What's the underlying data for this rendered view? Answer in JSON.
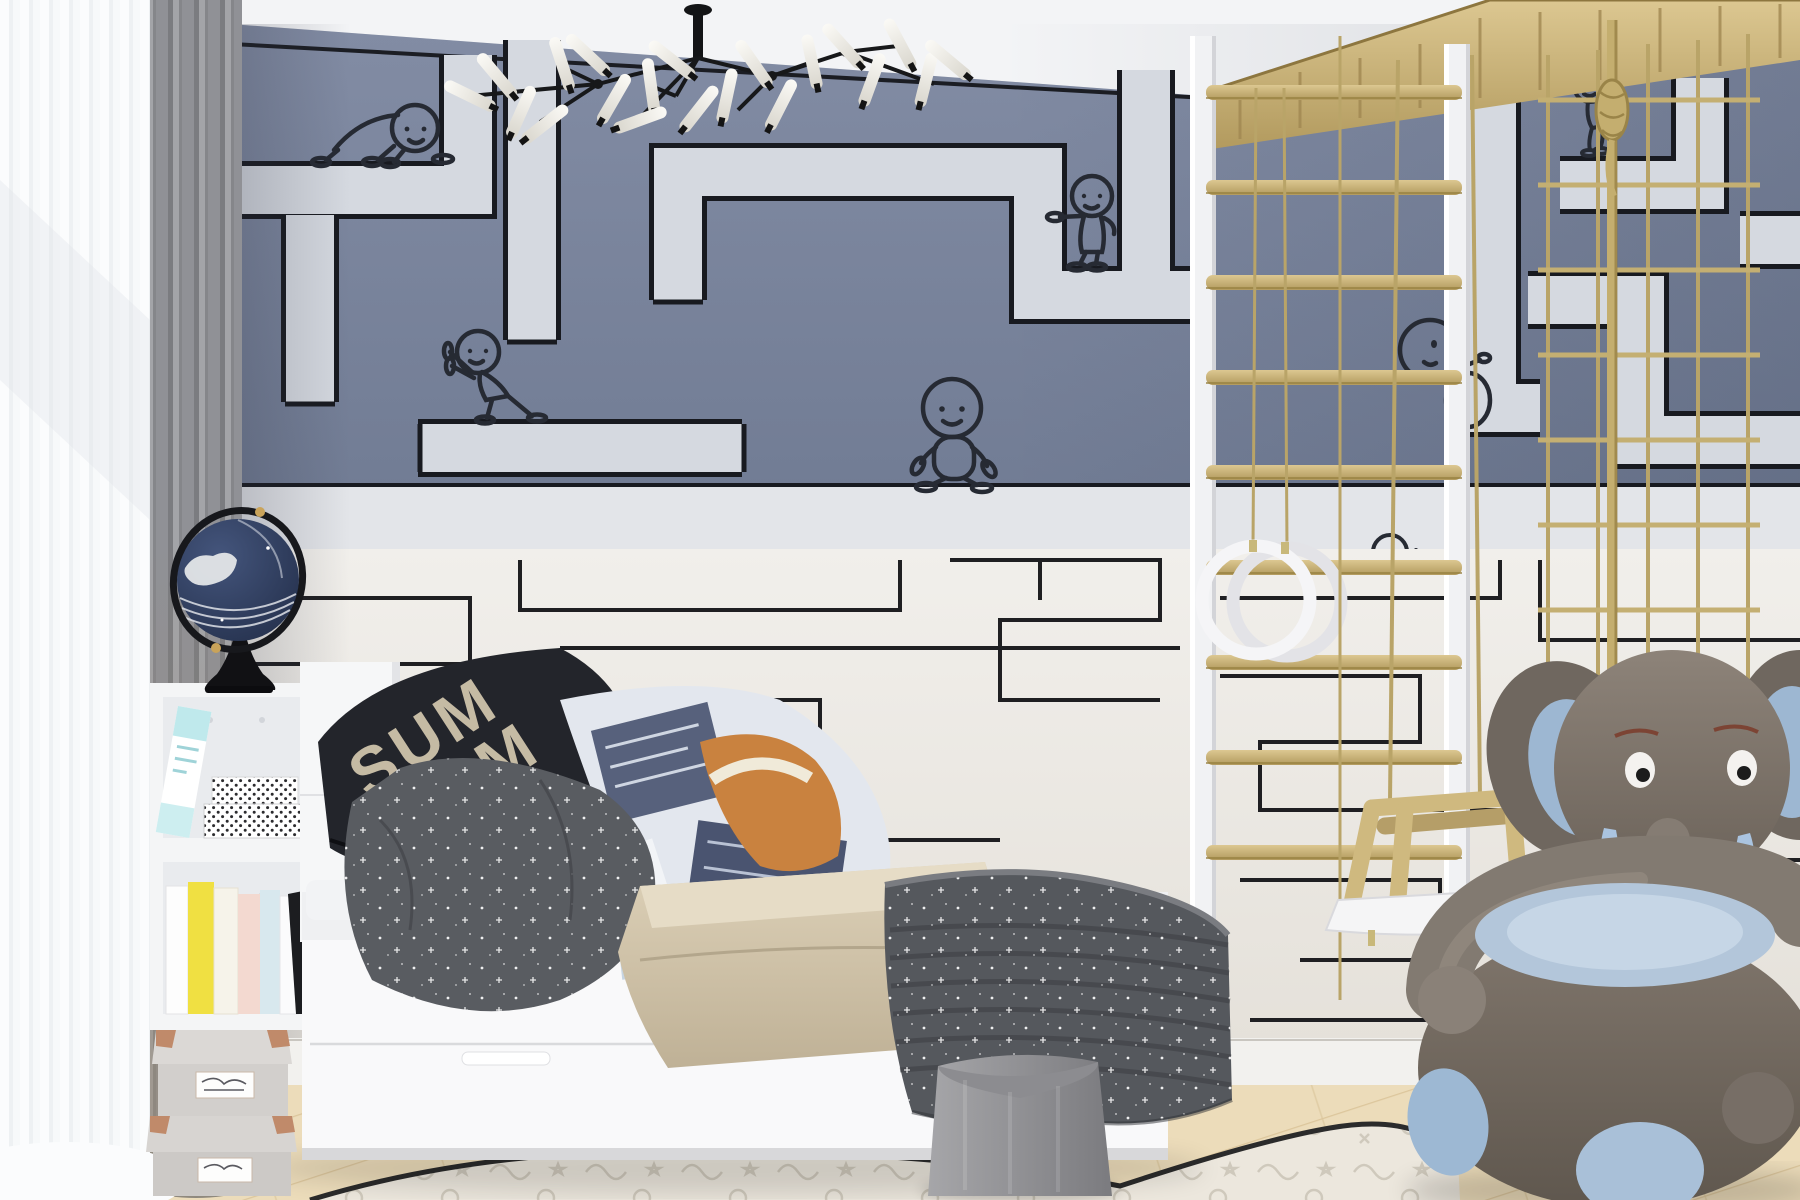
{
  "image_type": "children's bedroom interior photograph",
  "palette": {
    "wall_upper_blue": "#7a849c",
    "wall_lower_white": "#edeae5",
    "maze_path_light": "#d5d9e0",
    "maze_line_dark": "#1b1d23",
    "wood": "#cdb87e",
    "rope": "#bca76b",
    "floor_oak": "#ecdcba",
    "curtain_gray": "#8f9094",
    "elephant_body": "#7e756c",
    "elephant_blue": "#a9c2dc",
    "globe_navy": "#2e3c5c",
    "bedding_dark_gray": "#55585d",
    "bedding_orange": "#c9823f"
  },
  "mural": {
    "style": "two-tone maze wallpaper",
    "upper_section": "slate blue with wide light corridors outlined in black",
    "lower_section": "off-white with thin black maze lines",
    "figures": [
      {
        "pose": "crawling baby",
        "area": "upper left"
      },
      {
        "pose": "pushing against wall",
        "area": "upper left-center"
      },
      {
        "pose": "walking on white band",
        "area": "center"
      },
      {
        "pose": "waving",
        "area": "upper center-right"
      },
      {
        "pose": "climbing",
        "area": "behind ladder ropes"
      },
      {
        "pose": "small waving",
        "area": "right of rings"
      },
      {
        "pose": "hanging from rope",
        "area": "top right behind net"
      }
    ]
  },
  "lighting": {
    "fixture": "black branch chandelier with tube bulbs",
    "bulb_count": 20
  },
  "window": {
    "sheer_curtain": "white",
    "drape_curtain": "gray"
  },
  "decor": {
    "globe": "navy globe with white continents on black stand",
    "bookshelf_books": [
      "white",
      "yellow",
      "cream",
      "pink",
      "light blue",
      "white",
      "black"
    ],
    "patterned_boxes": 2,
    "storage_boxes_with_copper_corners": 2
  },
  "bed": {
    "frame": "white storage bed with drawers",
    "drawer_handles": 2,
    "pillow_text_top": "SUM",
    "pillow_text_bottom": "LAM",
    "print_badge": "STAR",
    "bedding": [
      "black slogan pillow",
      "gray star pillow",
      "space print duvet",
      "orange print pillow",
      "beige blanket",
      "gray star quilt"
    ]
  },
  "play_equipment": {
    "ladder_rungs": 9,
    "gym_rings": 2,
    "swing": "wooden swing with white seat",
    "net": "rope climbing net",
    "frame_posts": "white"
  },
  "toys": {
    "elephant_chair": "gray plush armchair with light blue accents"
  },
  "floor": {
    "material": "light oak planks",
    "rug": "white doodle rug with dark border"
  },
  "basket": {
    "color": "gray fabric storage basket"
  }
}
